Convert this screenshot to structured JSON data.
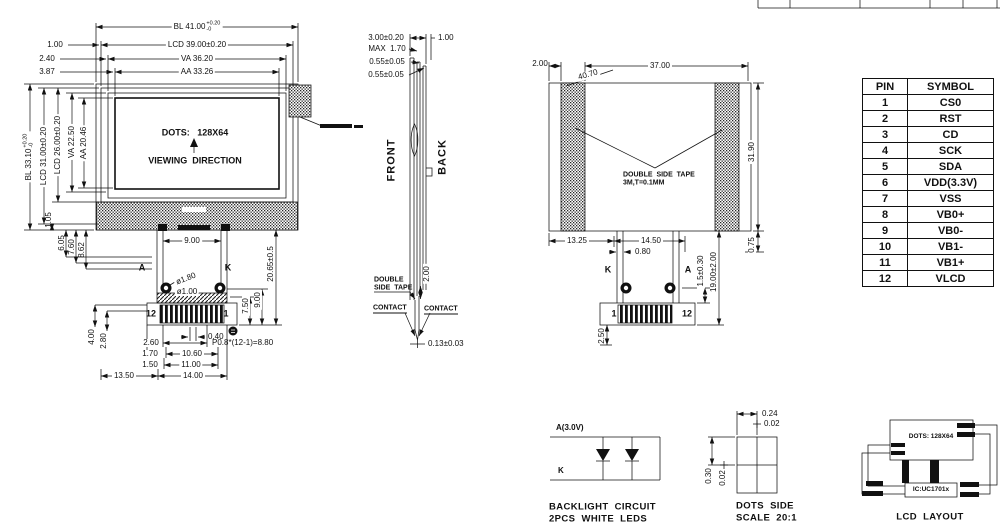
{
  "colors": {
    "line": "#111111",
    "background": "#ffffff"
  },
  "front_view": {
    "screen": {
      "dots": "DOTS:   128X64",
      "viewing": "VIEWING  DIRECTION"
    },
    "top": {
      "bl": "BL 41.00",
      "bl_plus": "+0.20",
      "bl_minus": "-0",
      "lcd": "LCD 39.00±0.20",
      "va": "VA 36.20",
      "aa": "AA 33.26",
      "o1": "1.00",
      "o2": "2.40",
      "o3": "3.87"
    },
    "left": {
      "bl": "BL 33.10",
      "bl_plus": "+0.20",
      "bl_minus": "-0",
      "lcd31": "LCD 31.00±0.20",
      "lcd26": "LCD 26.00±0.20",
      "va": "VA 22.50",
      "aa": "AA 20.46"
    },
    "left_bottom": {
      "v1": "1.05",
      "v2": "6.05",
      "v3": "7.60",
      "v4": "8.62"
    },
    "tail": {
      "w9": "9.00",
      "a": "A",
      "k": "K",
      "dia1": "ø1.80",
      "dia2": "ø1.00",
      "h20": "20.65±0.5",
      "h9": "9.00",
      "h75": "7.50",
      "pin12": "12",
      "pin1": "1",
      "g040": "0.40",
      "l400": "4.00",
      "l280": "2.80",
      "b260": "2.60",
      "pitch": "P0.8*(12-1)=8.80",
      "b170": "1.70",
      "b1060": "10.60",
      "b150": "1.50",
      "b1100": "11.00",
      "b1350": "13.50",
      "b1400": "14.00"
    }
  },
  "side_view": {
    "front": "FRONT",
    "back": "BACK",
    "t300": "3.00±0.20",
    "t170": "MAX  1.70",
    "t055a": "0.55±0.05",
    "t055b": "0.55±0.05",
    "t100": "1.00",
    "tape1": "DOUBLE",
    "tape2": "SIDE  TAPE",
    "g200": "2.00",
    "contact_l": "CONTACT",
    "contact_r": "CONTACT",
    "thk": "0.13±0.03"
  },
  "back_view": {
    "t200": "2.00",
    "t4070": "40.70",
    "t3700": "37.00",
    "tape1": "DOUBLE  SIDE  TAPE",
    "tape2": "3M,T=0.1MM",
    "r3190": "31.90",
    "r075": "0.75",
    "b1325": "13.25",
    "b1450": "14.50",
    "b080": "0.80",
    "k": "K",
    "a": "A",
    "r15": "1.5±0.30",
    "r19": "19.00±2.00",
    "pin1": "1",
    "pin12": "12",
    "b250": "2.50"
  },
  "pin_table": {
    "headers": [
      "PIN",
      "SYMBOL"
    ],
    "rows": [
      [
        "1",
        "CS0"
      ],
      [
        "2",
        "RST"
      ],
      [
        "3",
        "CD"
      ],
      [
        "4",
        "SCK"
      ],
      [
        "5",
        "SDA"
      ],
      [
        "6",
        "VDD(3.3V)"
      ],
      [
        "7",
        "VSS"
      ],
      [
        "8",
        "VB0+"
      ],
      [
        "9",
        "VB0-"
      ],
      [
        "10",
        "VB1-"
      ],
      [
        "11",
        "VB1+"
      ],
      [
        "12",
        "VLCD"
      ]
    ]
  },
  "backlight": {
    "anode": "A(3.0V)",
    "cathode": "K",
    "cap1": "BACKLIGHT  CIRCUIT",
    "cap2": "2PCS  WHITE  LEDS"
  },
  "dots_detail": {
    "w": "0.24",
    "wg": "0.02",
    "h": "0.30",
    "hg": "0.02",
    "cap1": "DOTS  SIDE",
    "cap2": "SCALE  20:1"
  },
  "lcd_layout": {
    "box": "DOTS: 128X64",
    "ic": "IC:UC1701x",
    "cap": "LCD  LAYOUT"
  }
}
